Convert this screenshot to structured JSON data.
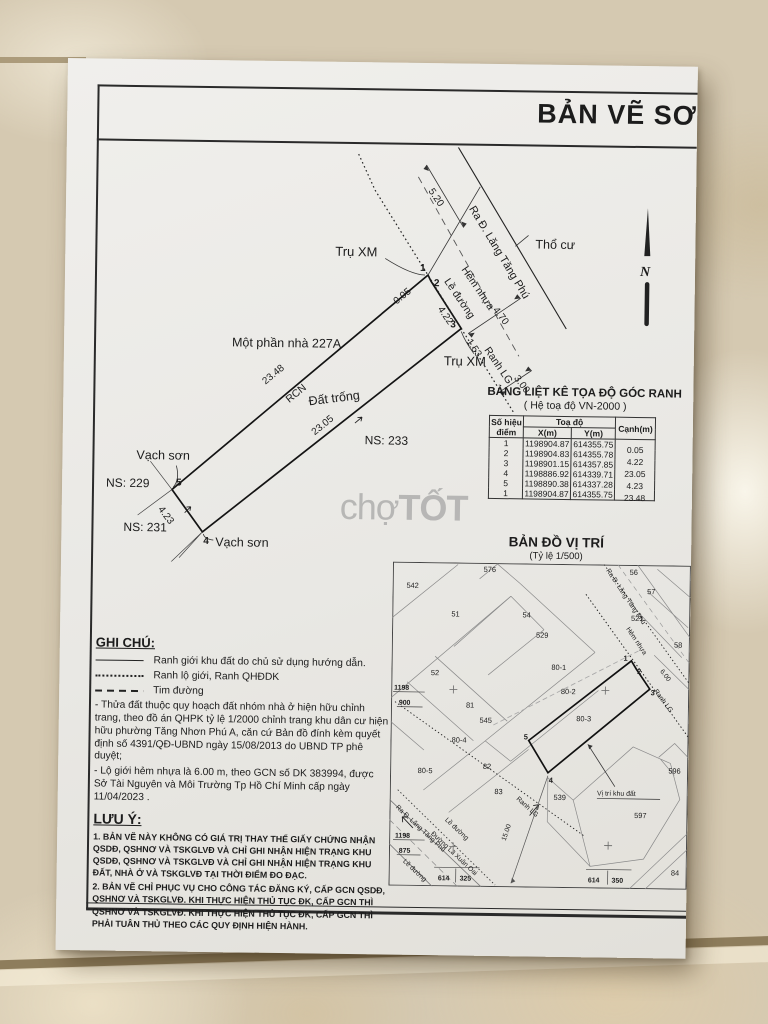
{
  "colors": {
    "paper": "#ecebe7",
    "tile": "#d5c9b1",
    "ink": "#1c1c1c"
  },
  "title": "BẢN VẼ SƠ",
  "north_label": "N",
  "watermark": {
    "prefix": "chợ",
    "suffix": "TỐT"
  },
  "survey": {
    "labels": {
      "tru_xm_top": "Trụ XM",
      "tru_xm_bot": "Trụ XM",
      "ra_duong": "Ra Đ. Lăng Tăng Phú",
      "tho_cu": "Thổ cư",
      "hem_nhua": "Hẻm nhựa",
      "le_duong": "Lề đường",
      "ranh_lg": "Ranh LG",
      "mot_phan": "Một phần nhà 227A",
      "rcn": "RCN",
      "dat_trong": "Đất trống",
      "ns233": "NS: 233",
      "ns229": "NS: 229",
      "ns231": "NS: 231",
      "vach_son_1": "Vạch sơn",
      "vach_son_2": "Vạch sơn"
    },
    "dims": {
      "d520": "5.20",
      "d470": "4.70",
      "d300": "3.00",
      "d005": "0.05",
      "d422": "4.22",
      "d153": "1.53",
      "d2348": "23.48",
      "d2305": "23.05",
      "d423": "4.23"
    },
    "points": {
      "p1": "1",
      "p2": "2",
      "p3": "3",
      "p4": "4",
      "p5": "5"
    }
  },
  "table": {
    "title": "BẢNG LIỆT KÊ TỌA ĐỘ GÓC RANH",
    "subtitle": "( Hệ toạ độ VN-2000 )",
    "col_point_l1": "Số hiệu",
    "col_point_l2": "điểm",
    "col_toado": "Toạ độ",
    "col_x": "X(m)",
    "col_y": "Y(m)",
    "col_canh": "Cạnh(m)",
    "rows": [
      {
        "p": "1",
        "x": "1198904.87",
        "y": "614355.75",
        "c": ""
      },
      {
        "p": "2",
        "x": "1198904.83",
        "y": "614355.78",
        "c": "0.05"
      },
      {
        "p": "3",
        "x": "1198901.15",
        "y": "614357.85",
        "c": "4.22"
      },
      {
        "p": "4",
        "x": "1198886.92",
        "y": "614339.71",
        "c": "23.05"
      },
      {
        "p": "5",
        "x": "1198890.38",
        "y": "614337.28",
        "c": "4.23"
      },
      {
        "p": "1",
        "x": "1198904.87",
        "y": "614355.75",
        "c": "23.48"
      }
    ]
  },
  "map": {
    "title": "BẢN ĐỒ VỊ TRÍ",
    "scale": "(Tỷ lệ 1/500)",
    "parcels": {
      "p542": "542",
      "p576": "576",
      "p51": "51",
      "p54": "54",
      "p529": "529",
      "p56": "56",
      "p57": "57",
      "p521": "521",
      "p58": "58",
      "p52": "52",
      "p81": "81",
      "p545": "545",
      "p80_1": "80-1",
      "p80_2": "80-2",
      "p80_3": "80-3",
      "p80_4": "80-4",
      "p80_5": "80-5",
      "p82": "82",
      "p83": "83",
      "p539": "539",
      "p596": "596",
      "p597": "597",
      "p84": "84"
    },
    "grid": {
      "g1198a": "1198",
      "g900": "900",
      "g1198b": "1198",
      "g875": "875",
      "g614a": "614",
      "g325": "325",
      "g614b": "614",
      "g350": "350"
    },
    "labels": {
      "ra_duong_top": "Ra Đ. Lăng Tăng Phú",
      "ra_duong_bot": "Ra Đ. Lăng Tăng Phú",
      "hem_nhua": "Hẻm nhựa",
      "ranh_lg_1": "Ranh LG",
      "ranh_lg_2": "Ranh LG",
      "d600": "6.00",
      "d1500": "15.00",
      "le_duong_1": "Lề đường",
      "le_duong_2": "Lề đường",
      "la_xuan_oai": "Đường Lã Xuân Oai",
      "vi_tri": "Vị trí khu đất"
    },
    "points": {
      "p1": "1",
      "p2": "2",
      "p3": "3",
      "p4": "4",
      "p5": "5"
    }
  },
  "notes": {
    "ghichu_title": "GHI CHÚ:",
    "legend": [
      {
        "style": "solid",
        "label": "Ranh giới khu đất do chủ sử dụng hướng dẫn."
      },
      {
        "style": "dotted",
        "label": "Ranh lộ giới, Ranh QHĐDK"
      },
      {
        "style": "dashed",
        "label": "Tim đường"
      }
    ],
    "para1": "- Thửa đất thuộc quy hoạch đất nhóm nhà ở hiện hữu chỉnh trang, theo đồ án QHPK tỷ lệ 1/2000 chỉnh trang khu dân cư hiện hữu phường Tăng Nhơn Phú A, căn cứ Bản đồ đính kèm quyết định số 4391/QĐ-UBND ngày 15/08/2013 do UBND TP phê duyệt;",
    "para2": "- Lộ giới hẻm nhựa là 6.00 m, theo GCN số DK 383994, được Sở Tài Nguyên và Môi Trường Tp Hồ Chí Minh cấp ngày 11/04/2023 .",
    "luuy_title": "LƯU Ý:",
    "item1": "1. BẢN VẼ NÀY KHÔNG CÓ GIÁ TRỊ THAY THẾ GIẤY CHỨNG NHẬN QSDĐ, QSHNƠ VÀ TSKGLVĐ VÀ CHỈ GHI NHẬN HIỆN TRẠNG KHU QSDĐ, QSHNƠ VÀ TSKGLVĐ VÀ CHỈ GHI NHẬN HIỆN TRẠNG KHU ĐẤT, NHÀ Ở VÀ TSKGLVĐ TẠI THỜI ĐIỂM ĐO ĐẠC.",
    "item2": "2. BẢN VẼ CHỈ PHỤC VỤ CHO CÔNG TÁC ĐĂNG KÝ, CẤP GCN QSDĐ, QSHNƠ VÀ TSKGLVĐ. KHI THỰC HIỆN THỦ TỤC ĐK, CẤP GCN THÌ QSHNƠ VÀ TSKGLVĐ. KHI THỰC HIỆN THỦ TỤC ĐK, CẤP GCN THÌ PHẢI TUÂN THỦ THEO CÁC QUY ĐỊNH HIỆN HÀNH."
  }
}
